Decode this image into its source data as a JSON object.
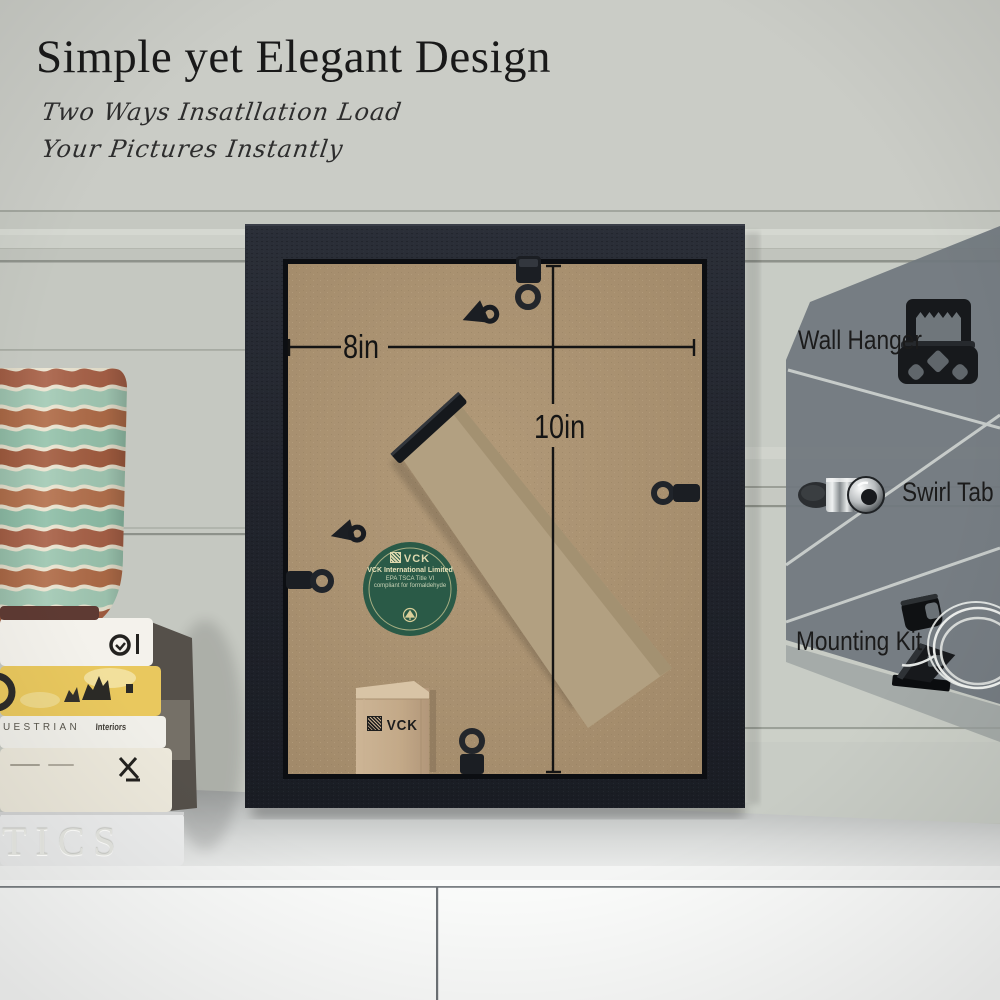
{
  "header": {
    "title": "Simple yet Elegant Design",
    "subtitle_line1": "Two Ways Insatllation Load",
    "subtitle_line2": "Your Pictures Instantly"
  },
  "dimensions": {
    "width_label": "8in",
    "height_label": "10in"
  },
  "callouts": [
    {
      "label": "Wall Hanger",
      "icon": "sawtooth-hanger-icon"
    },
    {
      "label": "Swirl Tab",
      "icon": "swirl-tab-icon"
    },
    {
      "label": "Mounting Kit",
      "icon": "mounting-kit-icon"
    }
  ],
  "sticker": {
    "brand": "VCK",
    "line1": "VCK International Limited",
    "line2": "EPA TSCA Title VI",
    "line3": "compliant for formaldehyde"
  },
  "bag": {
    "brand": "VCK"
  },
  "books": {
    "spine_equestrian": "UESTRIAN",
    "spine_equestrian_sub": "Interiors",
    "spine_embossed": "TICS"
  },
  "colors": {
    "wall": "#c5c8c1",
    "frame_black": "#22252d",
    "backing_kraft": "#a8906f",
    "sticker_green": "#2a5a47",
    "panel_gray": "#747b80",
    "text_dark": "#1c1c1c"
  }
}
